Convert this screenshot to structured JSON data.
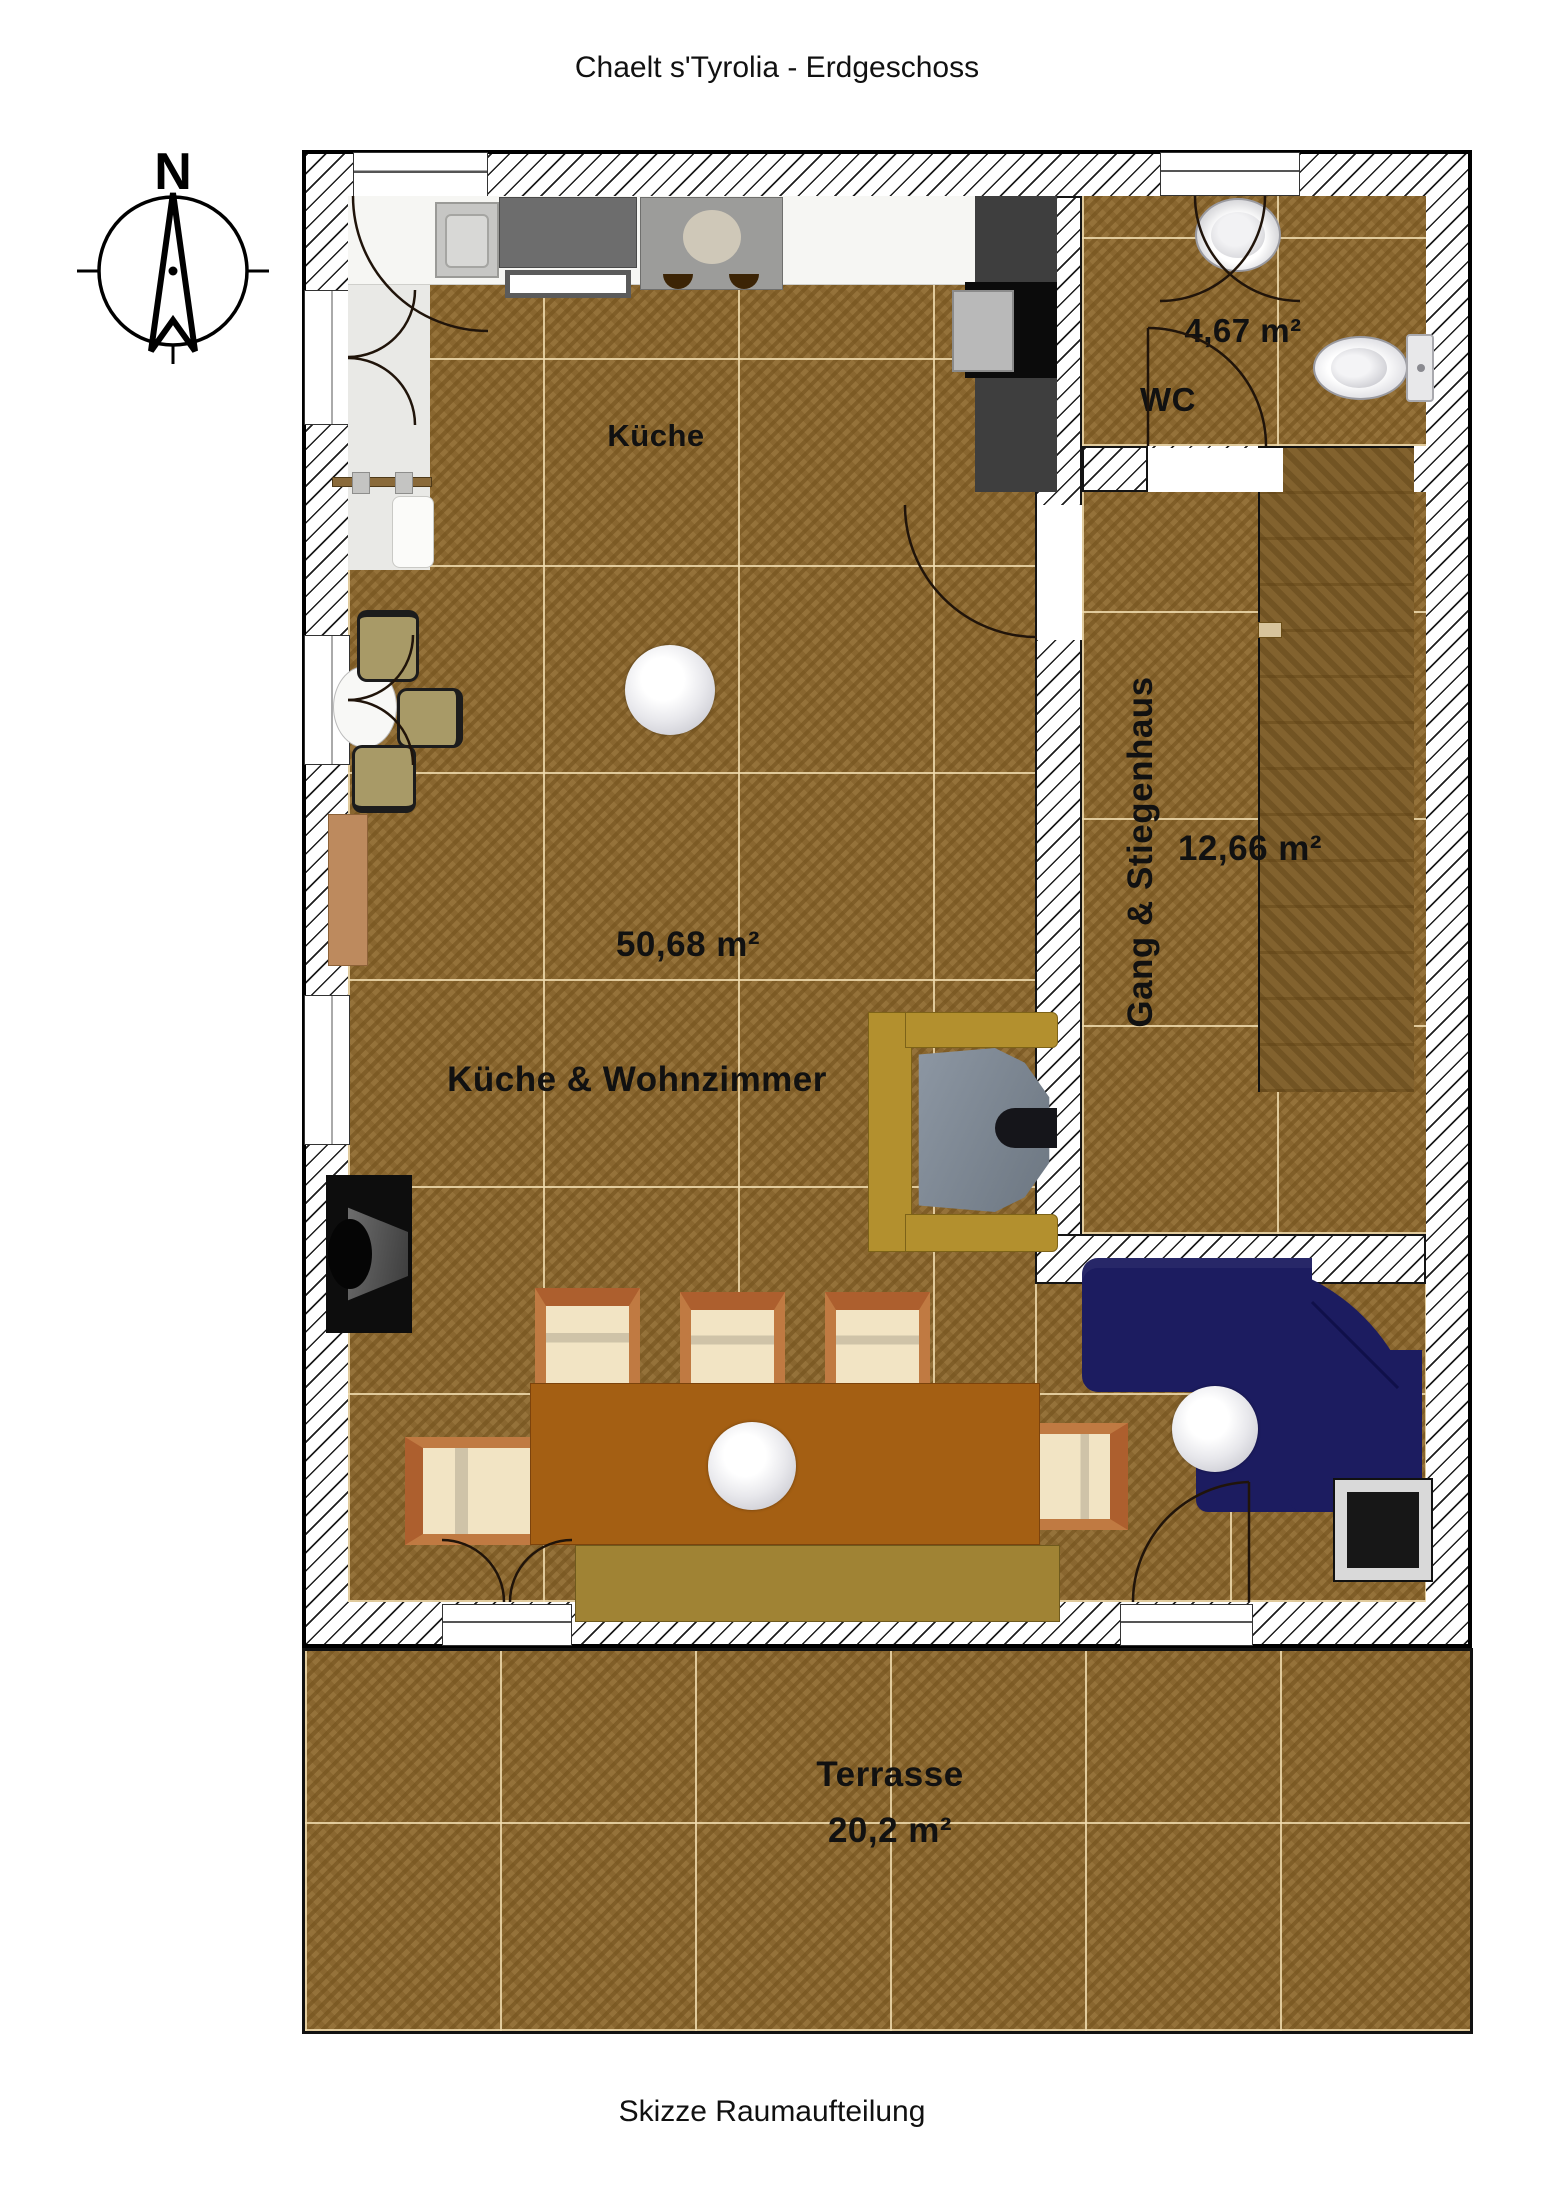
{
  "title": "Chaelt s'Tyrolia - Erdgeschoss",
  "caption": "Skizze Raumaufteilung",
  "compass": {
    "north": "N"
  },
  "rooms": {
    "kitchen": {
      "label": "Küche"
    },
    "living": {
      "label": "Küche & Wohnzimmer",
      "area": "50,68 m²"
    },
    "wc": {
      "label": "WC",
      "area": "4,67 m²"
    },
    "hall": {
      "label": "Gang & Stiegenhaus",
      "area": "12,66 m²"
    },
    "terrace": {
      "label": "Terrasse",
      "area": "20,2 m²"
    }
  },
  "colors": {
    "floor_wood": "#8f6a2f",
    "stairs_wood": "#7d5c26",
    "sofa_navy": "#1c1c60",
    "dining_table_brown": "#a45f13",
    "tv_cabinet_gold": "#b3902e",
    "bench_olive": "#a08334",
    "chair_cream": "#f2e4c4",
    "chair_frame": "#b96f35",
    "sideboard_tan": "#bd8a5e",
    "wall_line": "#111111"
  }
}
